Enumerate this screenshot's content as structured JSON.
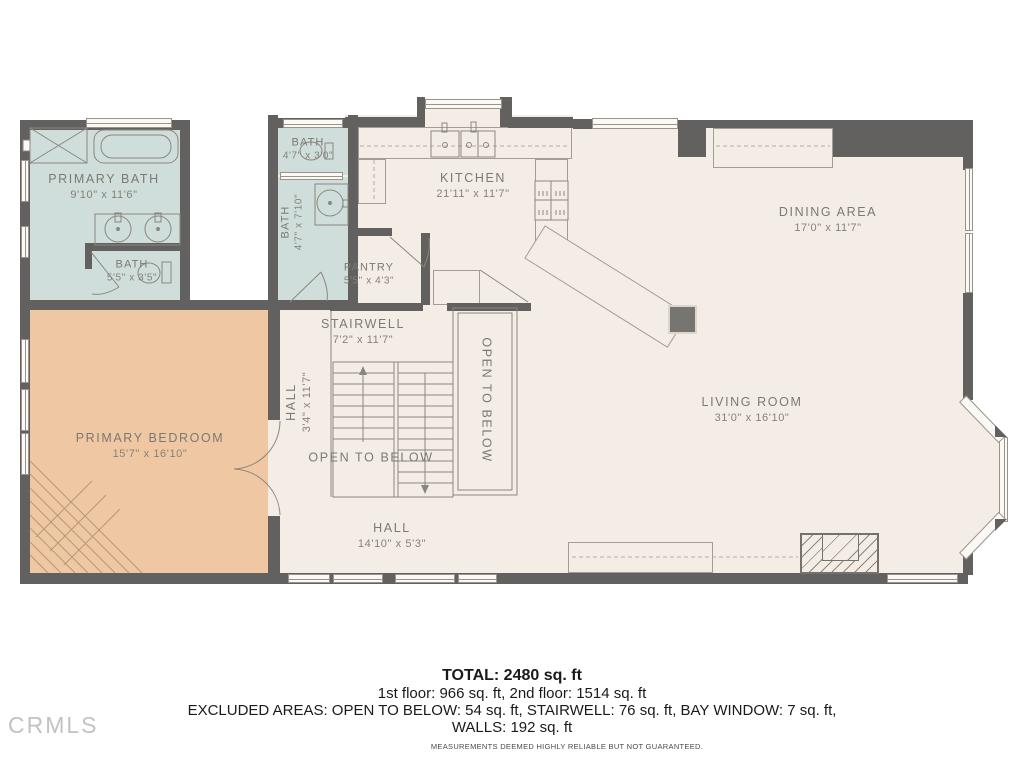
{
  "plan": {
    "rooms": {
      "primary_bath": {
        "name": "PRIMARY BATH",
        "dims": "9'10\" x 11'6\""
      },
      "bath_small": {
        "name": "BATH",
        "dims": "5'5\" x 3'5\""
      },
      "bath_upper": {
        "name": "BATH",
        "dims": "4'7\" x 3'0\""
      },
      "bath_mid": {
        "name": "BATH",
        "dims": "4'7\" x 7'10\""
      },
      "kitchen": {
        "name": "KITCHEN",
        "dims": "21'11\" x 11'7\""
      },
      "pantry": {
        "name": "PANTRY",
        "dims": "5'5\" x 4'3\""
      },
      "stairwell": {
        "name": "STAIRWELL",
        "dims": "7'2\" x 11'7\""
      },
      "hall_upper": {
        "name": "HALL",
        "dims": "3'4\" x 11'7\""
      },
      "open_below_left": {
        "name": "OPEN TO BELOW"
      },
      "open_below_right": {
        "name": "OPEN TO BELOW"
      },
      "primary_bedroom": {
        "name": "PRIMARY BEDROOM",
        "dims": "15'7\" x 16'10\""
      },
      "dining": {
        "name": "DINING AREA",
        "dims": "17'0\" x 11'7\""
      },
      "living": {
        "name": "LIVING ROOM",
        "dims": "31'0\" x 16'10\""
      },
      "hall_lower": {
        "name": "HALL",
        "dims": "14'10\" x 5'3\""
      }
    },
    "colors": {
      "wall": "#626160",
      "floor": "#f4ede6",
      "bath": "#cfdeda",
      "bedroom": "#efc7a2"
    }
  },
  "summary": {
    "total": "TOTAL: 2480 sq. ft",
    "floors": "1st floor: 966 sq. ft, 2nd floor: 1514 sq. ft",
    "excluded_line1": "EXCLUDED AREAS: OPEN TO BELOW: 54 sq. ft, STAIRWELL: 76 sq. ft, BAY WINDOW: 7 sq. ft,",
    "excluded_line2": "WALLS: 192 sq. ft",
    "disclaimer": "MEASUREMENTS DEEMED HIGHLY RELIABLE BUT NOT GUARANTEED."
  },
  "watermark": "CRMLS"
}
